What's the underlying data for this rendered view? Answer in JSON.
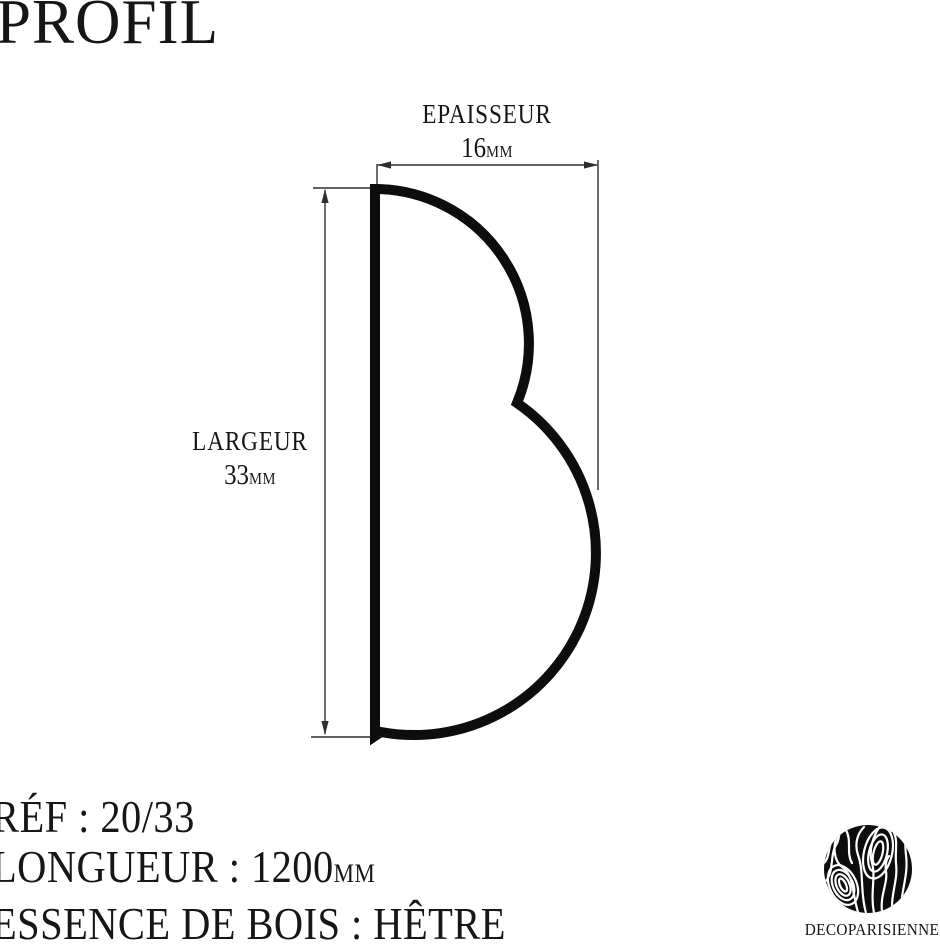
{
  "title": "PROFIL",
  "colors": {
    "ink": "#161616",
    "outline": "#0d0d0d",
    "dimension_line": "#2e2e2e",
    "background": "#ffffff"
  },
  "dimensions": {
    "thickness": {
      "label": "EPAISSEUR",
      "value": "16",
      "unit": "MM"
    },
    "width": {
      "label": "LARGEUR",
      "value": "33",
      "unit": "MM"
    }
  },
  "specs": {
    "reference": "RÉF : 20/33",
    "length_label": "LONGUEUR : 1200",
    "length_unit": "MM",
    "material": "ESSENCE DE BOIS : HÊTRE"
  },
  "brand": {
    "name": "DECOPARISIENNE"
  }
}
